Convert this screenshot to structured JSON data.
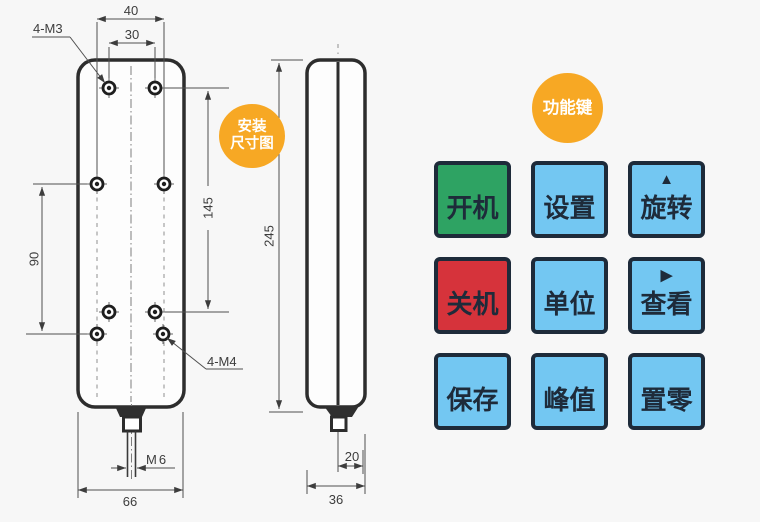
{
  "colors": {
    "background": "#f7f7f7",
    "badge_orange": "#F7A824",
    "key_green": "#2EA363",
    "key_blue": "#73C7F2",
    "key_red": "#D6333B",
    "key_border": "#1E2B3A",
    "outline_dark": "#2d2d2d"
  },
  "badges": {
    "install_dim": {
      "line1": "安装",
      "line2": "尺寸图"
    },
    "function_keys": {
      "label": "功能键"
    }
  },
  "front_view": {
    "labels": {
      "hole_top": "4-M3",
      "hole_bottom": "4-M4",
      "width_outer": "40",
      "width_inner": "30",
      "height_inner": "145",
      "height_outer": "90",
      "thread": "M6",
      "body_width": "66"
    }
  },
  "side_view": {
    "labels": {
      "height": "245",
      "offset": "20",
      "depth": "36"
    }
  },
  "keys": {
    "items": [
      {
        "label": "开机",
        "bg": "#2EA363",
        "arrow": ""
      },
      {
        "label": "设置",
        "bg": "#73C7F2",
        "arrow": ""
      },
      {
        "label": "旋转",
        "bg": "#73C7F2",
        "arrow": "▲"
      },
      {
        "label": "关机",
        "bg": "#D6333B",
        "arrow": ""
      },
      {
        "label": "单位",
        "bg": "#73C7F2",
        "arrow": ""
      },
      {
        "label": "查看",
        "bg": "#73C7F2",
        "arrow": "▶"
      },
      {
        "label": "保存",
        "bg": "#73C7F2",
        "arrow": ""
      },
      {
        "label": "峰值",
        "bg": "#73C7F2",
        "arrow": ""
      },
      {
        "label": "置零",
        "bg": "#73C7F2",
        "arrow": ""
      }
    ]
  }
}
